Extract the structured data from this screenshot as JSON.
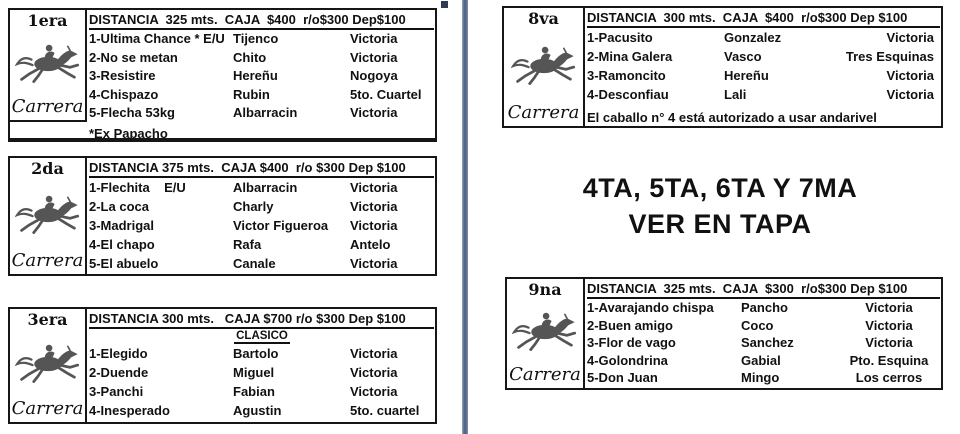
{
  "colors": {
    "divider": "#54688a",
    "border": "#161616",
    "text": "#111111"
  },
  "center_notice": {
    "line1": "4TA, 5TA, 6TA Y 7MA",
    "line2": "VER EN TAPA"
  },
  "races": [
    {
      "id": "1era",
      "label_top": "1era",
      "label_bottom": "Carrera",
      "header": "DISTANCIA  325 mts.  CAJA  $400  r/o$300 Dep$100",
      "entries": [
        {
          "name": "1-Ultima Chance * E/U",
          "jockey": "Tijenco",
          "stud": "Victoria"
        },
        {
          "name": "2-No se metan",
          "jockey": "Chito",
          "stud": "Victoria"
        },
        {
          "name": "3-Resistire",
          "jockey": "Hereñu",
          "stud": "Nogoya"
        },
        {
          "name": "4-Chispazo",
          "jockey": "Rubin",
          "stud": "5to. Cuartel"
        },
        {
          "name": "5-Flecha 53kg",
          "jockey": "Albarracin",
          "stud": "Victoria"
        }
      ],
      "footnote": "*Ex Papacho"
    },
    {
      "id": "2da",
      "label_top": "2da",
      "label_bottom": "Carrera",
      "header": "DISTANCIA 375 mts.  CAJA $400  r/o $300 Dep $100",
      "entries": [
        {
          "name": "1-Flechita    E/U",
          "jockey": "Albarracin",
          "stud": "Victoria"
        },
        {
          "name": "2-La coca",
          "jockey": "Charly",
          "stud": "Victoria"
        },
        {
          "name": "3-Madrigal",
          "jockey": "Victor Figueroa",
          "stud": "Victoria"
        },
        {
          "name": "4-El chapo",
          "jockey": "Rafa",
          "stud": "Antelo"
        },
        {
          "name": "5-El abuelo",
          "jockey": "Canale",
          "stud": "Victoria"
        }
      ]
    },
    {
      "id": "3era",
      "label_top": "3era",
      "label_bottom": "Carrera",
      "header": "DISTANCIA 300 mts.   CAJA $700 r/o $300 Dep $100",
      "subheader": "CLASICO",
      "entries": [
        {
          "name": "1-Elegido",
          "jockey": "Bartolo",
          "stud": "Victoria"
        },
        {
          "name": "2-Duende",
          "jockey": "Miguel",
          "stud": "Victoria"
        },
        {
          "name": "3-Panchi",
          "jockey": "Fabian",
          "stud": "Victoria"
        },
        {
          "name": "4-Inesperado",
          "jockey": "Agustin",
          "stud": "5to. cuartel"
        }
      ]
    },
    {
      "id": "8va",
      "label_top": "8va",
      "label_bottom": "Carrera",
      "header": "DISTANCIA  300 mts.  CAJA  $400  r/o$300 Dep $100",
      "entries": [
        {
          "name": "1-Pacusito",
          "jockey": "Gonzalez",
          "stud": "Victoria"
        },
        {
          "name": "2-Mina Galera",
          "jockey": "Vasco",
          "stud": "Tres Esquinas"
        },
        {
          "name": "3-Ramoncito",
          "jockey": "Hereñu",
          "stud": "Victoria"
        },
        {
          "name": "4-Desconfiau",
          "jockey": "Lali",
          "stud": "Victoria"
        }
      ],
      "note": "El caballo n° 4 está autorizado a usar andarivel"
    },
    {
      "id": "9na",
      "label_top": "9na",
      "label_bottom": "Carrera",
      "header": "DISTANCIA  325 mts.  CAJA  $300  r/o$300 Dep $100",
      "entries": [
        {
          "name": "1-Avarajando chispa",
          "jockey": "Pancho",
          "stud": "Victoria"
        },
        {
          "name": "2-Buen amigo",
          "jockey": "Coco",
          "stud": "Victoria"
        },
        {
          "name": "3-Flor de vago",
          "jockey": "Sanchez",
          "stud": "Victoria"
        },
        {
          "name": "4-Golondrina",
          "jockey": "Gabial",
          "stud": "Pto. Esquina"
        },
        {
          "name": "5-Don Juan",
          "jockey": "Mingo",
          "stud": "Los cerros"
        }
      ]
    }
  ]
}
